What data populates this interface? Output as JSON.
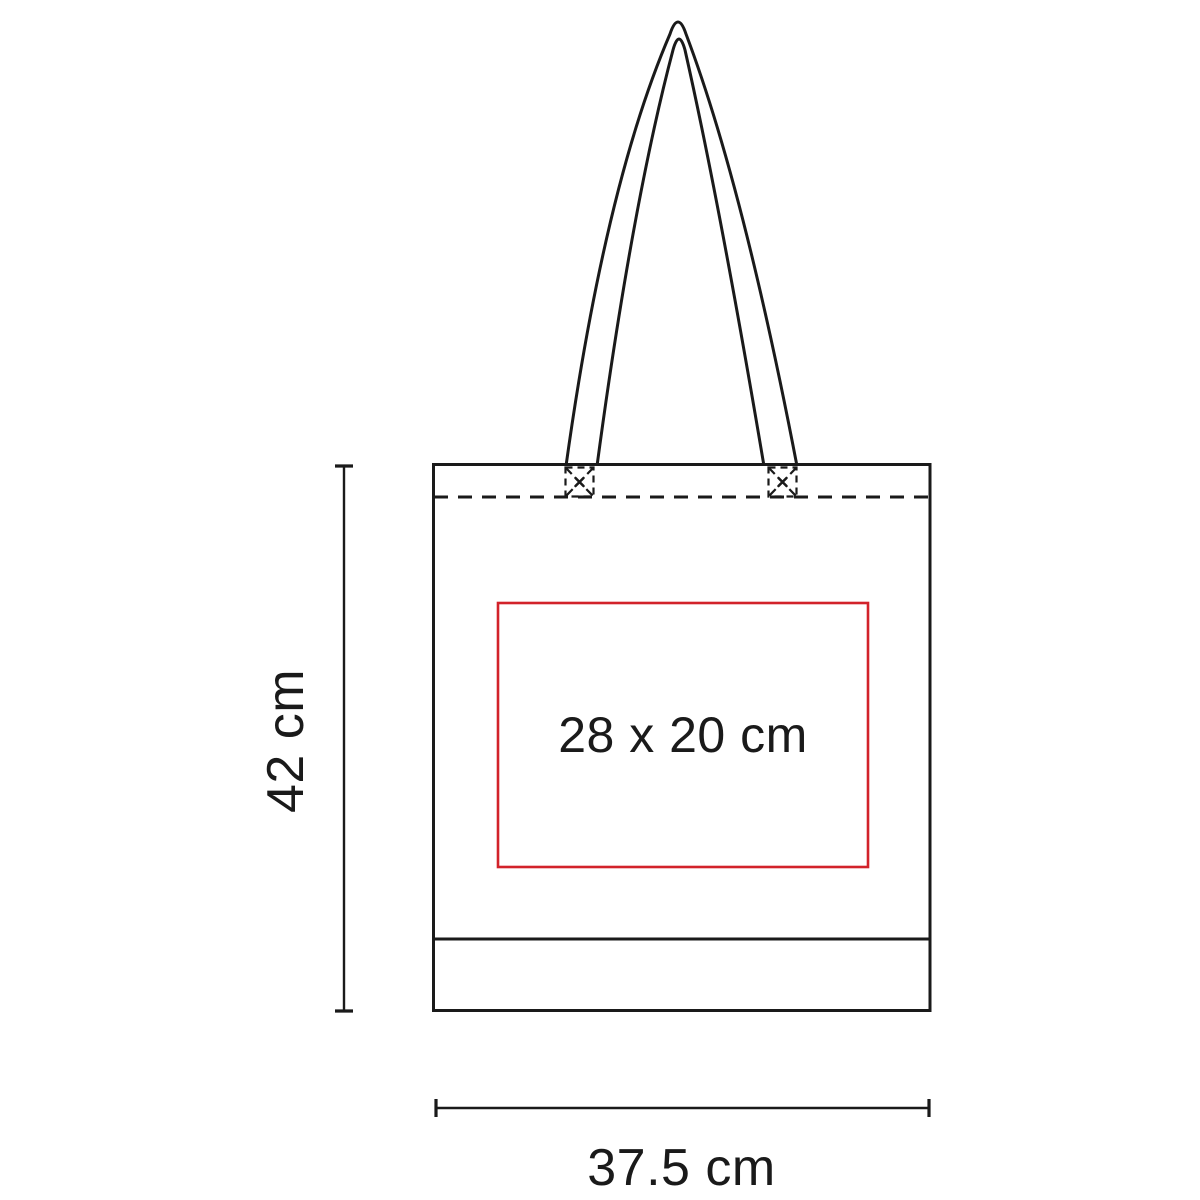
{
  "diagram": {
    "type": "product-dimension-diagram",
    "subject": "tote-bag",
    "labels": {
      "print_area": "28 x 20 cm",
      "bag_height": "42 cm",
      "bag_width": "37.5 cm"
    }
  },
  "colors": {
    "line": "#1a1a1a",
    "accent_red": "#d2222a",
    "background": "#ffffff"
  }
}
